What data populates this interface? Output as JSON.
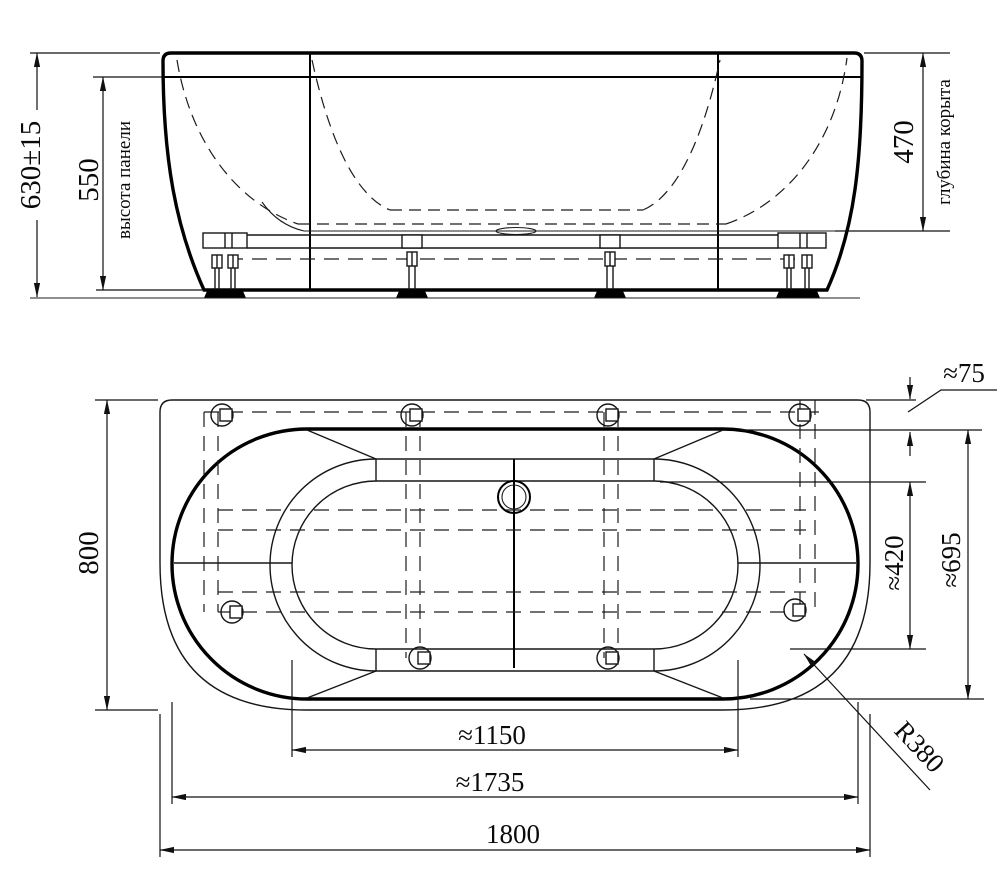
{
  "drawing": {
    "type": "technical-drawing",
    "subject": "oval-bathtub-with-frame",
    "line_color": "#000000",
    "background": "#ffffff"
  },
  "front_view": {
    "dim_total_height": "630±15",
    "dim_panel_height": "550",
    "caption_panel_height": "высота панели",
    "dim_bowl_depth": "470",
    "caption_bowl_depth": "глубина корыта"
  },
  "plan_view": {
    "dim_overall_width": "800",
    "dim_rim_gap": "≈75",
    "dim_bottom_width": "≈420",
    "dim_rim_width": "≈695",
    "dim_corner_radius": "R380",
    "dim_bottom_length": "≈1150",
    "dim_rim_length": "≈1735",
    "dim_overall_length": "1800"
  }
}
